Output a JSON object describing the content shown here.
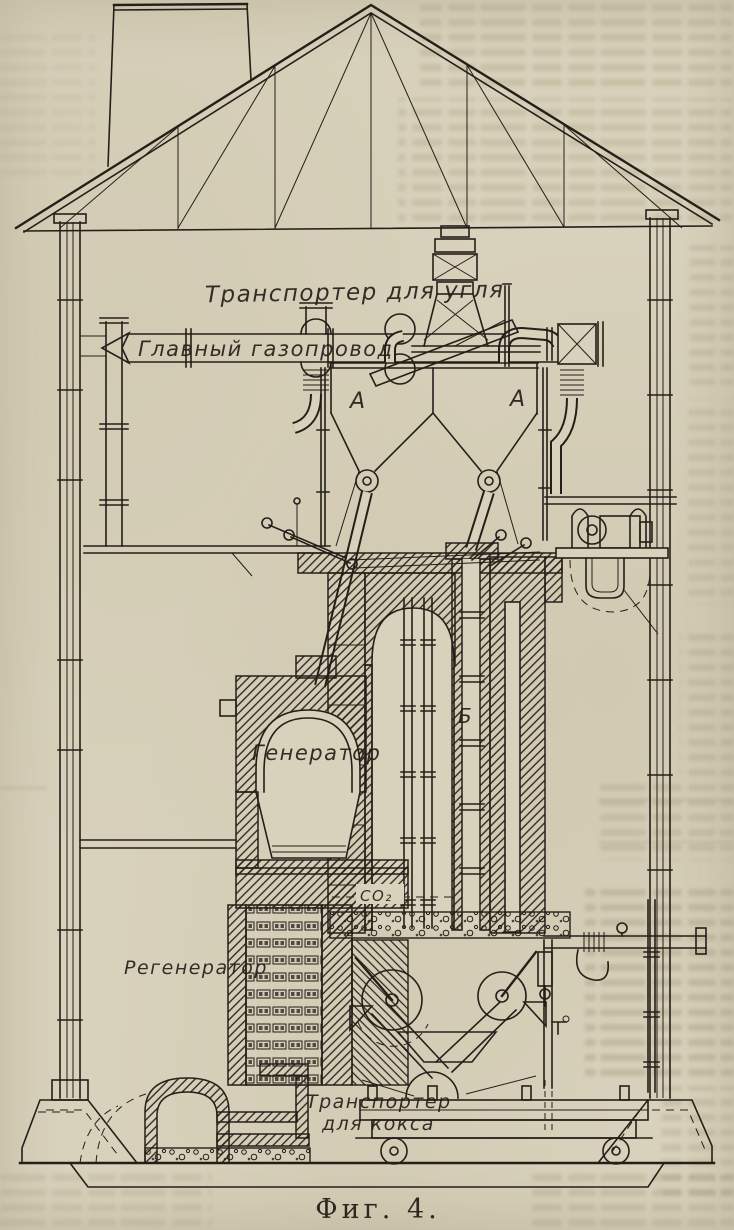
{
  "figure": {
    "caption": "Фиг. 4.",
    "labels": {
      "coal_conveyor": "Транспортер для угля",
      "main_gas_pipeline": "Главный газопровод",
      "hopper_left": "А",
      "hopper_right": "А",
      "shaft": "Б",
      "generator": "Генератор",
      "regenerator": "Регенератор",
      "gas_co2": "CO₂",
      "coke_conveyor_line1": "Транспортер",
      "coke_conveyor_line2": "для кокса"
    },
    "colors": {
      "paper": "#d8d1bb",
      "ink": "#241f19"
    }
  }
}
